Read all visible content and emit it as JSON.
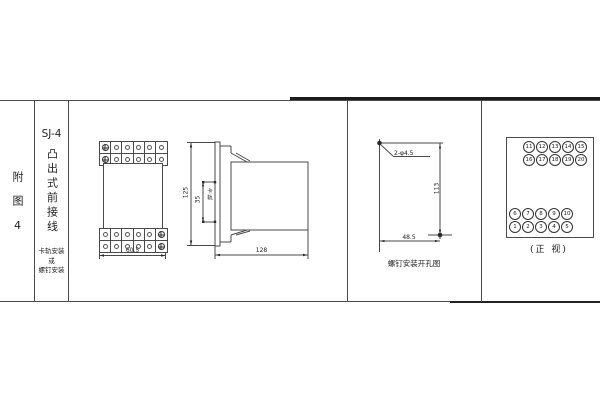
{
  "colors": {
    "paper": "#ffffff",
    "ink": "#222222",
    "line": "#4a4a4a"
  },
  "left_panel": {
    "figure_label": "附图4",
    "model": "SJ-4",
    "model_type": "凸出式前接线",
    "mount_lines": [
      "卡轨安装",
      "或",
      "螺钉安装"
    ]
  },
  "front_view": {
    "grid": {
      "rows": 2,
      "cols": 6
    },
    "width_dim": "60.5"
  },
  "side_view": {
    "height_dim": "125",
    "rail_height_dim": "35",
    "rail_label": "卡轨",
    "depth_dim": "128"
  },
  "drill_view": {
    "hole_label": "2-φ4.5",
    "height_dim": "113",
    "width_dim": "48.5",
    "caption": "螺钉安装开孔图"
  },
  "terminal_view": {
    "rows": [
      [
        "11",
        "12",
        "13",
        "14",
        "15"
      ],
      [
        "16",
        "17",
        "18",
        "19",
        "20"
      ],
      [
        "6",
        "7",
        "8",
        "9",
        "10"
      ],
      [
        "1",
        "2",
        "3",
        "4",
        "5"
      ]
    ],
    "caption": "(正 视)"
  }
}
